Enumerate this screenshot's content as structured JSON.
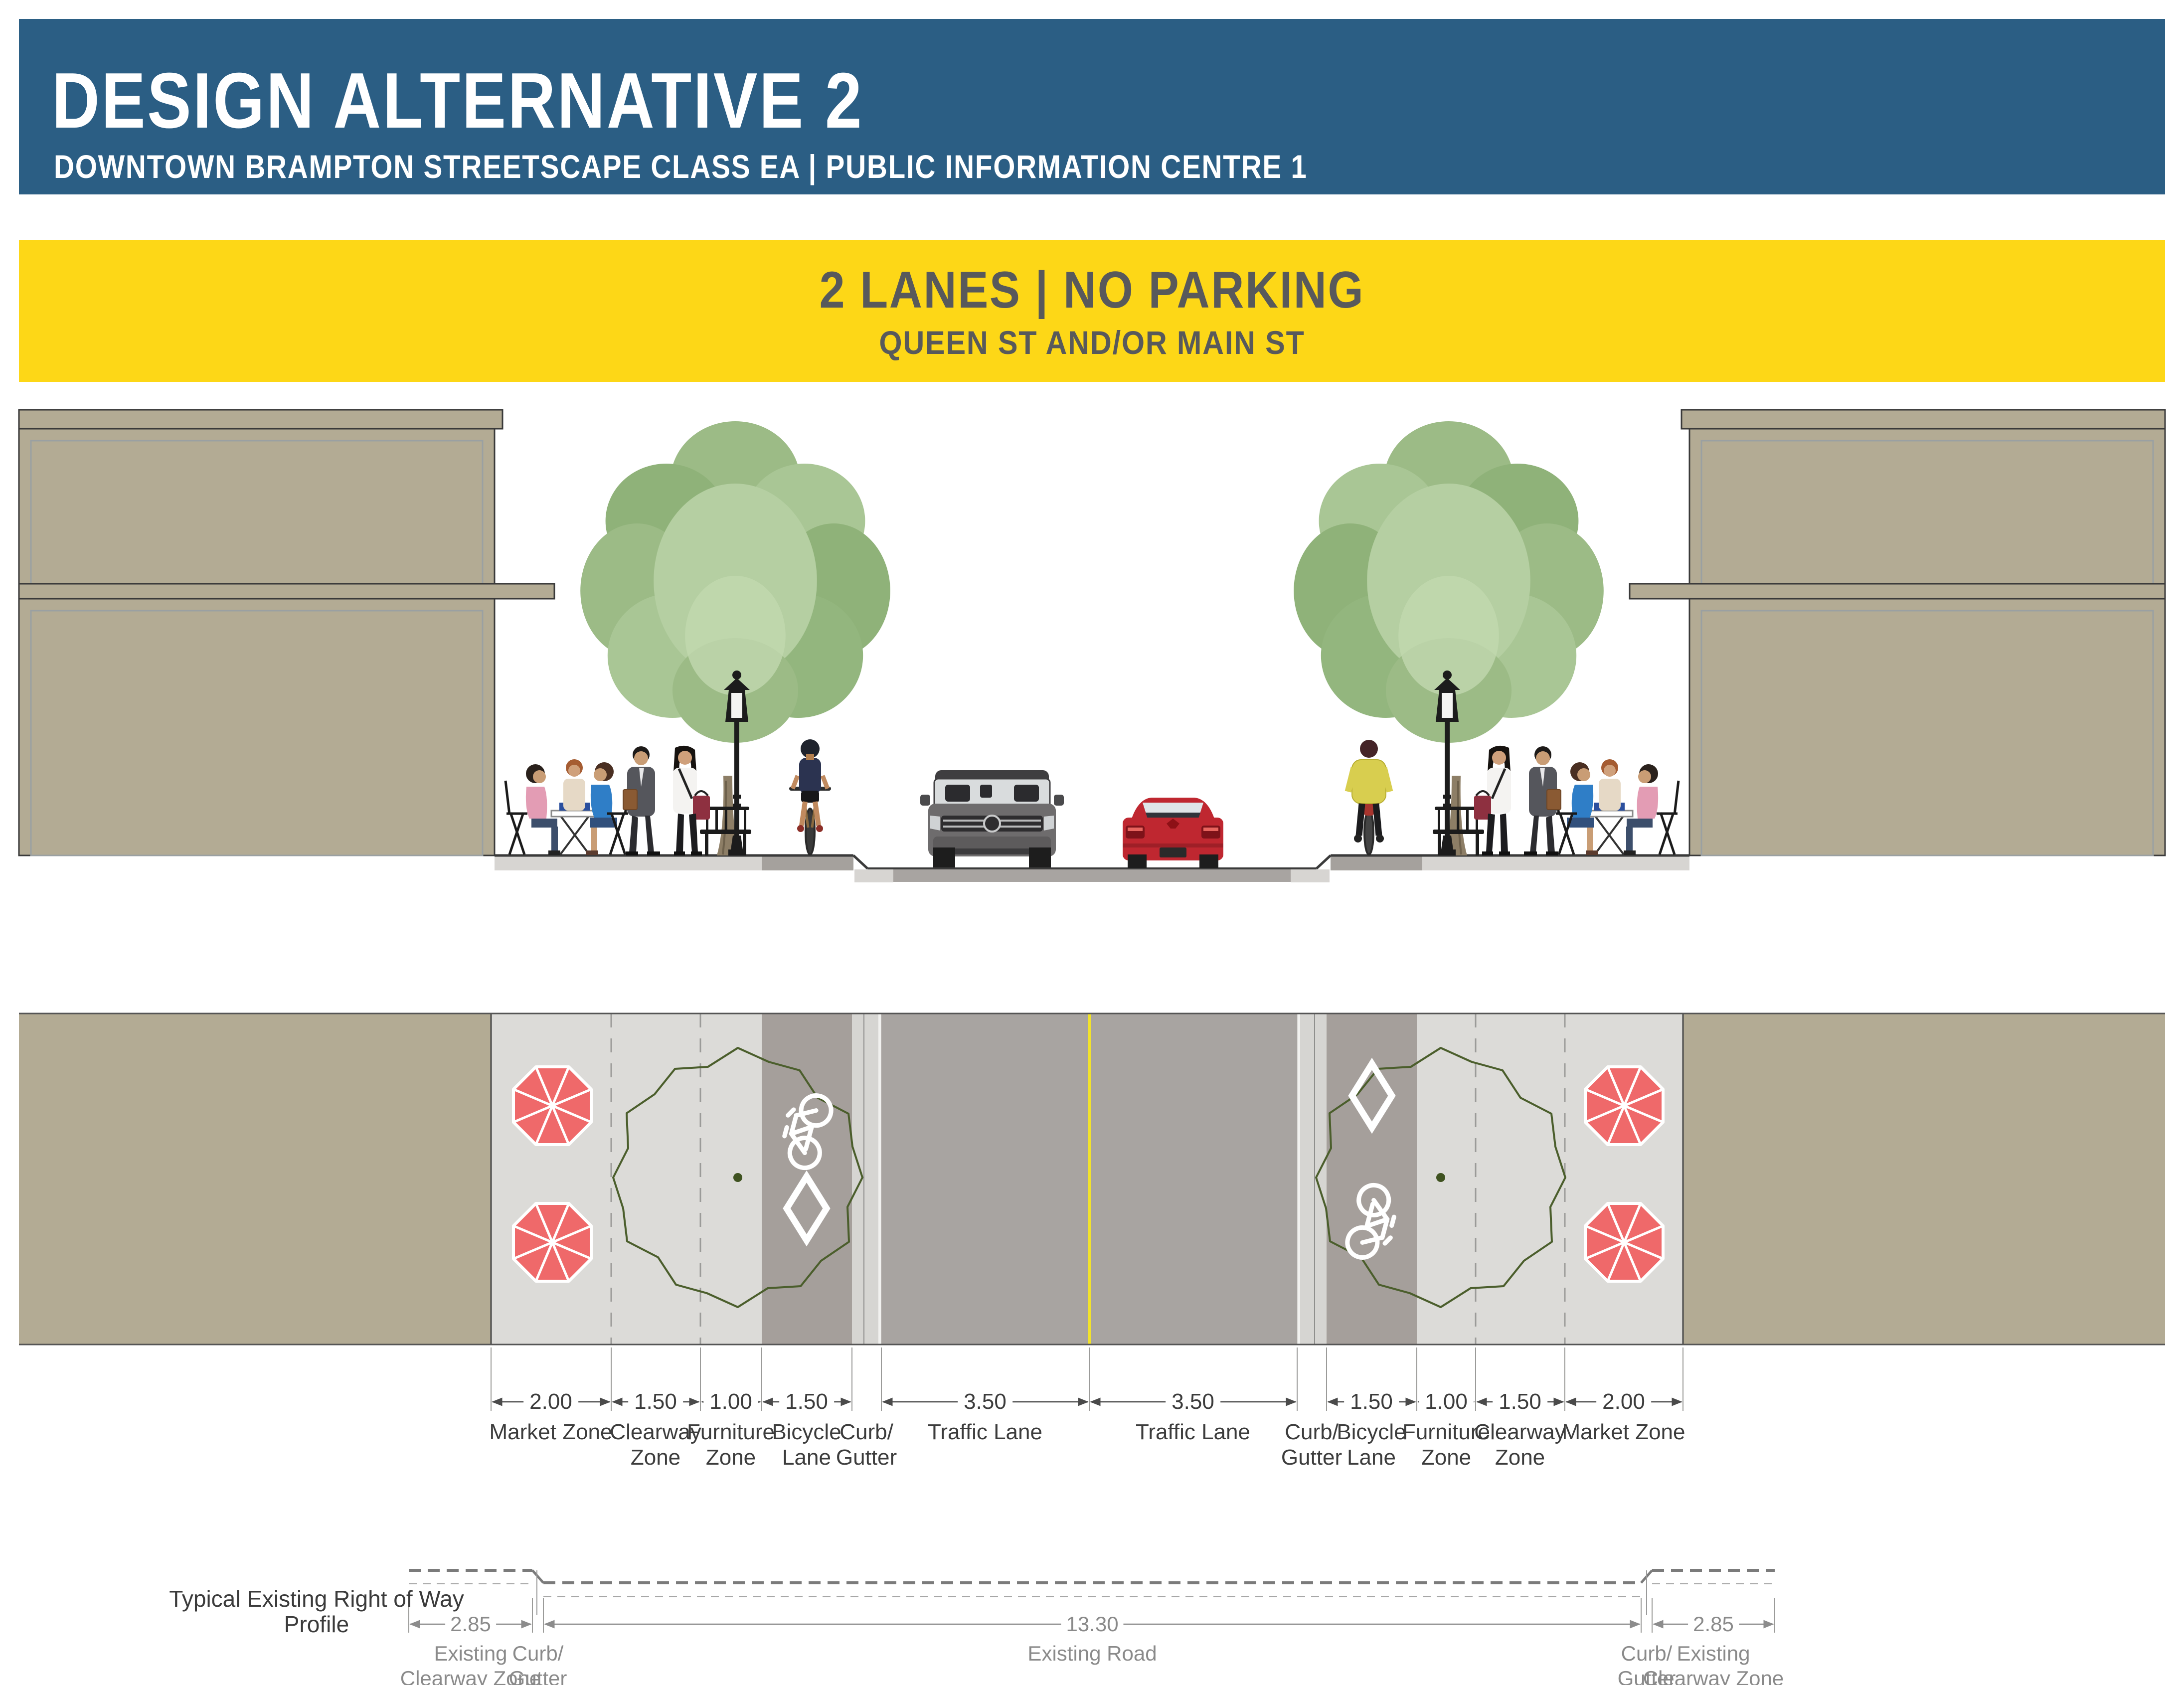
{
  "header": {
    "title": "DESIGN ALTERNATIVE 2",
    "subtitle": "DOWNTOWN BRAMPTON STREETSCAPE CLASS EA  |  PUBLIC INFORMATION CENTRE 1"
  },
  "banner": {
    "title": "2 LANES  |  NO PARKING",
    "subtitle": "QUEEN ST AND/OR MAIN ST"
  },
  "plan": {
    "dims": [
      {
        "value": "2.00",
        "label1": "Market Zone",
        "label2": ""
      },
      {
        "value": "1.50",
        "label1": "Clearway",
        "label2": "Zone"
      },
      {
        "value": "1.00",
        "label1": "Furniture",
        "label2": "Zone"
      },
      {
        "value": "1.50",
        "label1": "Bicycle",
        "label2": "Lane"
      },
      {
        "value": "",
        "label1": "Curb/",
        "label2": "Gutter"
      },
      {
        "value": "3.50",
        "label1": "Traffic Lane",
        "label2": ""
      },
      {
        "value": "3.50",
        "label1": "Traffic Lane",
        "label2": ""
      },
      {
        "value": "",
        "label1": "Curb/",
        "label2": "Gutter"
      },
      {
        "value": "1.50",
        "label1": "Bicycle",
        "label2": "Lane"
      },
      {
        "value": "1.00",
        "label1": "Furniture",
        "label2": "Zone"
      },
      {
        "value": "1.50",
        "label1": "Clearway",
        "label2": "Zone"
      },
      {
        "value": "2.00",
        "label1": "Market Zone",
        "label2": ""
      }
    ]
  },
  "profile": {
    "title": "Typical Existing Right of Way Profile",
    "dims": [
      {
        "value": "2.85",
        "label1": "Existing",
        "label2": "Clearway Zone"
      },
      {
        "value": "",
        "label1": "Curb/",
        "label2": "Gutter"
      },
      {
        "value": "13.30",
        "label1": "Existing Road",
        "label2": ""
      },
      {
        "value": "",
        "label1": "Curb/",
        "label2": "Gutter"
      },
      {
        "value": "2.85",
        "label1": "Existing",
        "label2": "Clearway Zone"
      }
    ]
  },
  "colors": {
    "header_blue": "#2b5e84",
    "banner_yellow": "#fdd717",
    "banner_text": "#58595b",
    "building_tan": "#b3ab94",
    "sidewalk_light": "#dcdbd8",
    "bike_lane_gray": "#a59f9b",
    "road_gray": "#a8a4a1",
    "curb_gray": "#d6d5d2",
    "centerline_yellow": "#f2e32b",
    "umbrella_red": "#ef696a",
    "canopy_outline_green": "#4b5e2c"
  }
}
